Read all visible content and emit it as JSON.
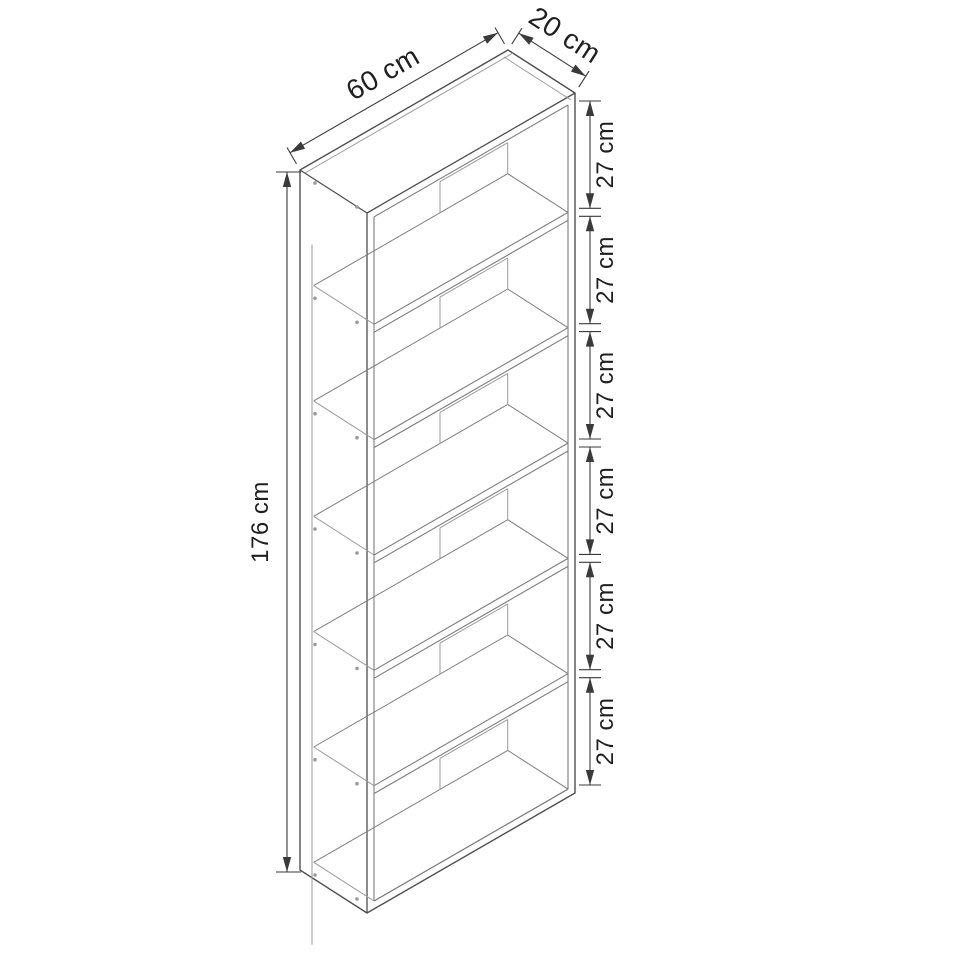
{
  "diagram": {
    "labels": {
      "width": "60 cm",
      "depth": "20 cm",
      "height": "176 cm",
      "shelf_gaps": [
        "27 cm",
        "27 cm",
        "27 cm",
        "27 cm",
        "27 cm",
        "27 cm"
      ]
    },
    "values": {
      "width_cm": 60,
      "depth_cm": 20,
      "height_cm": 176,
      "compartments": 6,
      "compartment_height_cm": 27,
      "board_thickness_cm": 2
    },
    "colors": {
      "background": "#ffffff",
      "outline": "#4f4f4f",
      "detail": "#7d7d7d",
      "light": "#9a9a9a",
      "dimension": "#3a3a3a",
      "text": "#1f1f1f"
    }
  }
}
